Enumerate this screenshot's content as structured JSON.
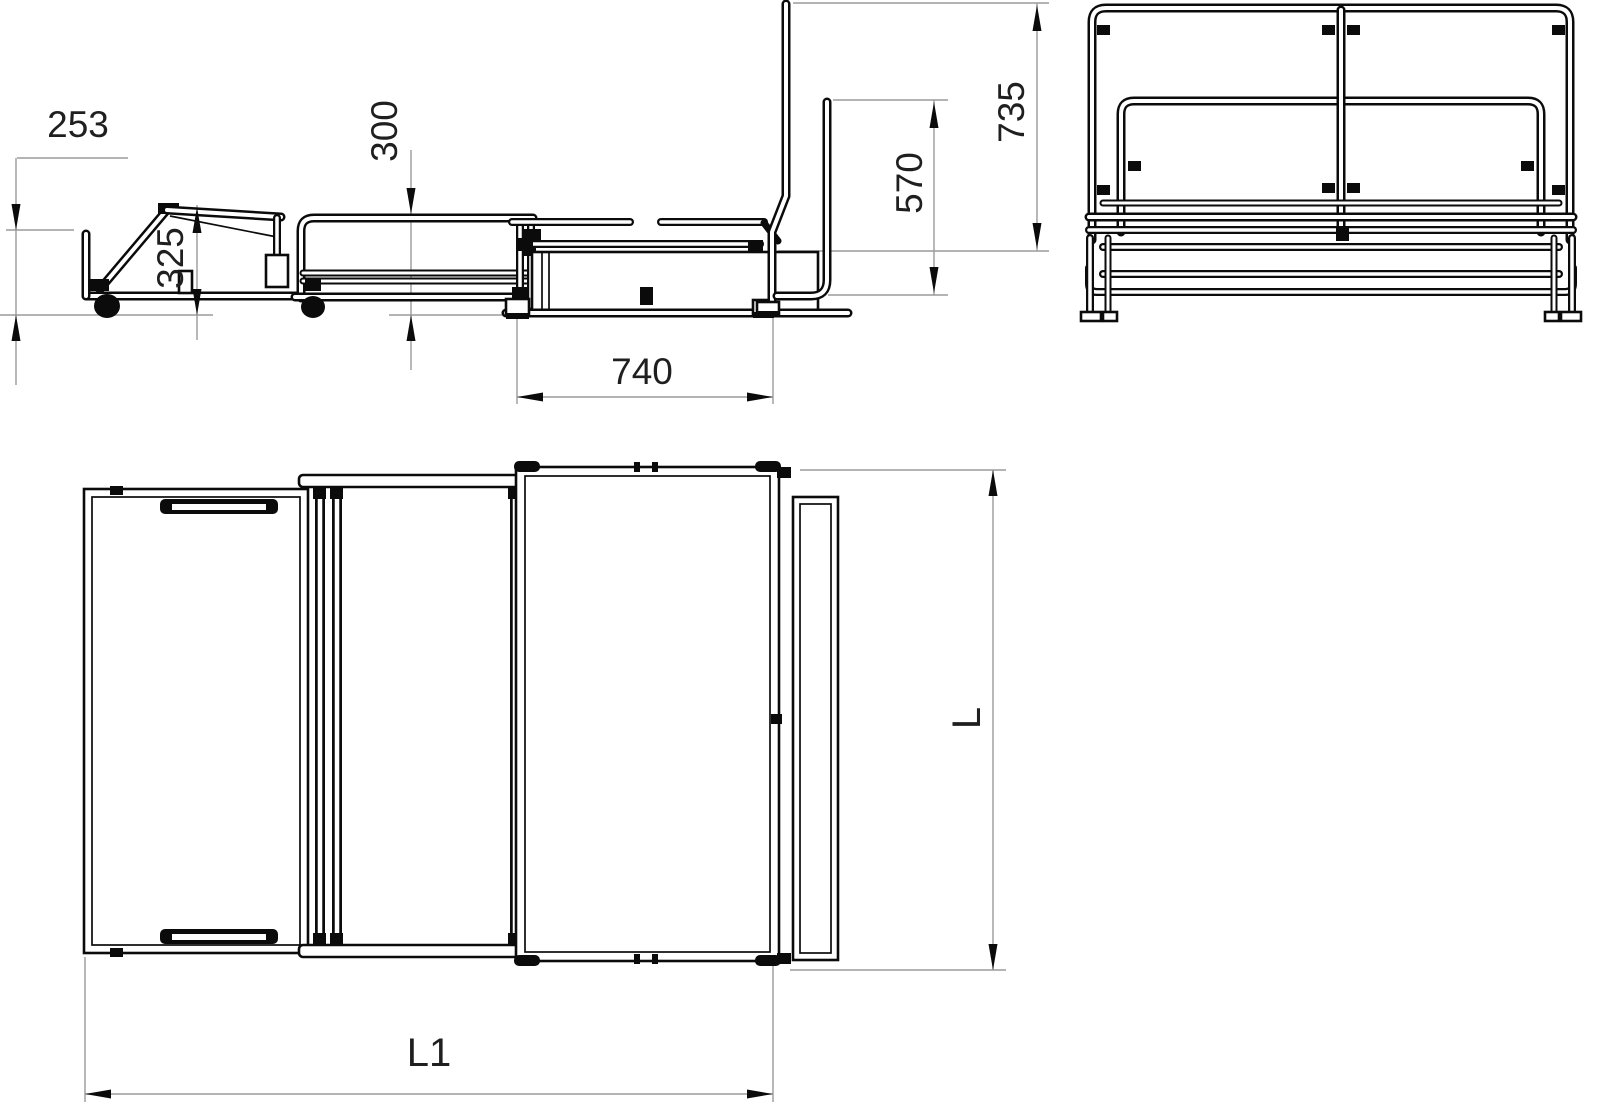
{
  "drawing": {
    "type": "furniture-fold-out-bed-technical-drawing",
    "background": "#ffffff",
    "object_line_color": "#0b0b0b",
    "dimension_line_color": "#9b9b9b",
    "text_color": "#1f1f1f"
  },
  "dims": {
    "d253": "253",
    "d325": "325",
    "d300": "300",
    "d740": "740",
    "d570": "570",
    "d735": "735",
    "L1": "L1",
    "L": "L"
  }
}
